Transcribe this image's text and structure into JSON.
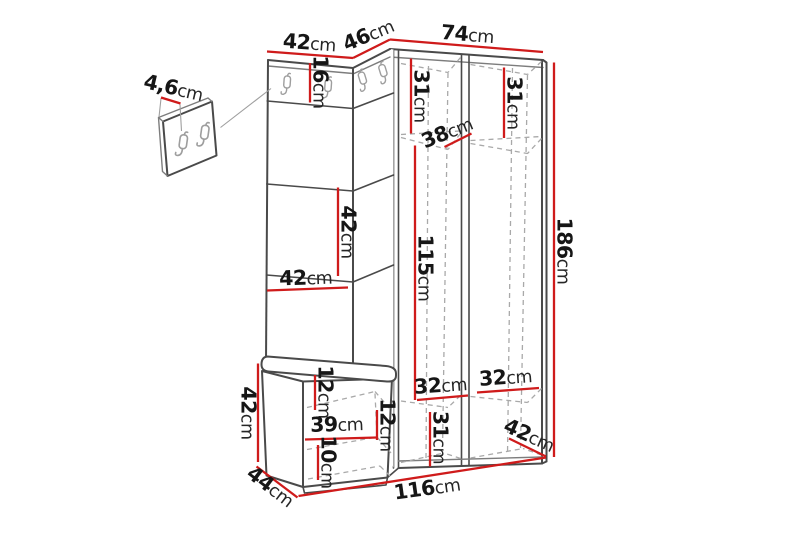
{
  "figure": {
    "background_color": "#ffffff",
    "dimension_line_color": "#cf1b1b",
    "outline_color": "#4a4a4a",
    "hidden_line_color": "#a9a9a9",
    "label_color": "#161616",
    "subject": "hallway corner wardrobe with coat hooks, upholstered panel and shoe bench, plus separate wall hook panel"
  },
  "dimensions": {
    "wall_panel_thickness": {
      "value": "4,6",
      "unit": "cm"
    },
    "top_panel_width": {
      "value": "42",
      "unit": "cm"
    },
    "top_corner_width": {
      "value": "46",
      "unit": "cm"
    },
    "top_wardrobe_width": {
      "value": "74",
      "unit": "cm"
    },
    "hook_rail_height": {
      "value": "16",
      "unit": "cm"
    },
    "left_top_shelf_depth": {
      "value": "31",
      "unit": "cm"
    },
    "right_top_shelf_depth": {
      "value": "31",
      "unit": "cm"
    },
    "top_shelf_diagonal": {
      "value": "38",
      "unit": "cm"
    },
    "panel_square_height": {
      "value": "42",
      "unit": "cm"
    },
    "panel_width": {
      "value": "42",
      "unit": "cm"
    },
    "wardrobe_interior_height": {
      "value": "115",
      "unit": "cm"
    },
    "total_height": {
      "value": "186",
      "unit": "cm"
    },
    "bench_height": {
      "value": "42",
      "unit": "cm"
    },
    "bench_upper_gap": {
      "value": "12",
      "unit": "cm"
    },
    "bench_interior_width": {
      "value": "39",
      "unit": "cm"
    },
    "bench_middle_gap": {
      "value": "12",
      "unit": "cm"
    },
    "bench_lower_gap": {
      "value": "10",
      "unit": "cm"
    },
    "bench_depth": {
      "value": "44",
      "unit": "cm"
    },
    "left_bottom_shelf_depth": {
      "value": "32",
      "unit": "cm"
    },
    "right_bottom_shelf_depth": {
      "value": "32",
      "unit": "cm"
    },
    "bottom_section_height": {
      "value": "31",
      "unit": "cm"
    },
    "wardrobe_bottom_depth": {
      "value": "42",
      "unit": "cm"
    },
    "total_width": {
      "value": "116",
      "unit": "cm"
    }
  }
}
